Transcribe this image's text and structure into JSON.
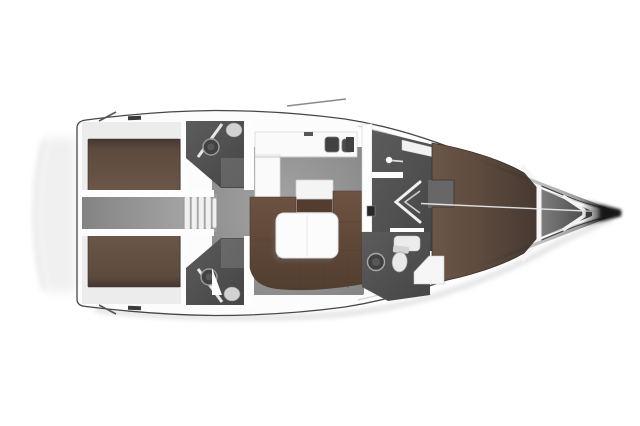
{
  "meta": {
    "title": "Sailing yacht interior layout plan",
    "view": "top-down deck plan, bow pointing right",
    "alt": "Rendered floor plan of a cruising sailboat with two aft double cabins, two aft heads, companionway steps, L-shaped galley, chart table, U-shaped settee with saloon table, forward head with shower, and forward V-berth cabin, tapering to the anchor locker at the bow"
  },
  "palette": {
    "bg": "#ffffff",
    "hull": "#fcfcfc",
    "hull_line": "#474747",
    "deck_line": "#c9c9c9",
    "cabin_band": "#ececec",
    "shadow": "#d6d6d6",
    "edge": "#2e2e2e",
    "tip": "#141414",
    "berth": "#5d4a3e",
    "berth_light": "#6b5648",
    "berth_dark": "#443730",
    "sofa": "#6e5342",
    "sofa_dark": "#523e2f",
    "nav_brown": "#543d2e",
    "floor": "#a3a3a3",
    "floor_dark": "#838383",
    "cabin_floor": "#696969",
    "notch_floor": "#676767",
    "head": "#5c5c5c",
    "head_dark": "#454545",
    "shower": "#7a7a7a",
    "locker_gray": "#7d7d7d",
    "fixture": "#f0f0f0",
    "white": "#fdfdfd",
    "sink": "#414141",
    "step_base": "#9e9e9e",
    "hardware": "#3b3b3b"
  },
  "regions": {
    "stern_platform": "Stern swim platform",
    "aft_cabin_port": "Aft double cabin (port)",
    "aft_cabin_starboard": "Aft double cabin (starboard)",
    "engine_passage": "Engine compartment passage",
    "companionway": "Companionway steps",
    "aft_head_port": "Aft head (port)",
    "aft_head_starboard": "Aft head (starboard)",
    "galley": "L-shaped galley with double sink",
    "nav_station": "Chart table",
    "saloon": "Saloon",
    "settee": "U-shaped settee",
    "saloon_table": "Saloon table",
    "vestibule": "Forward passage",
    "wardrobe": "Locker shelf",
    "cabin_door": "Forward cabin door",
    "forward_head": "Forward head with shower",
    "forward_cabin": "Forward cabin",
    "v_berth": "V-berth",
    "anchor_locker": "Anchor locker",
    "bow": "Bow tip"
  }
}
